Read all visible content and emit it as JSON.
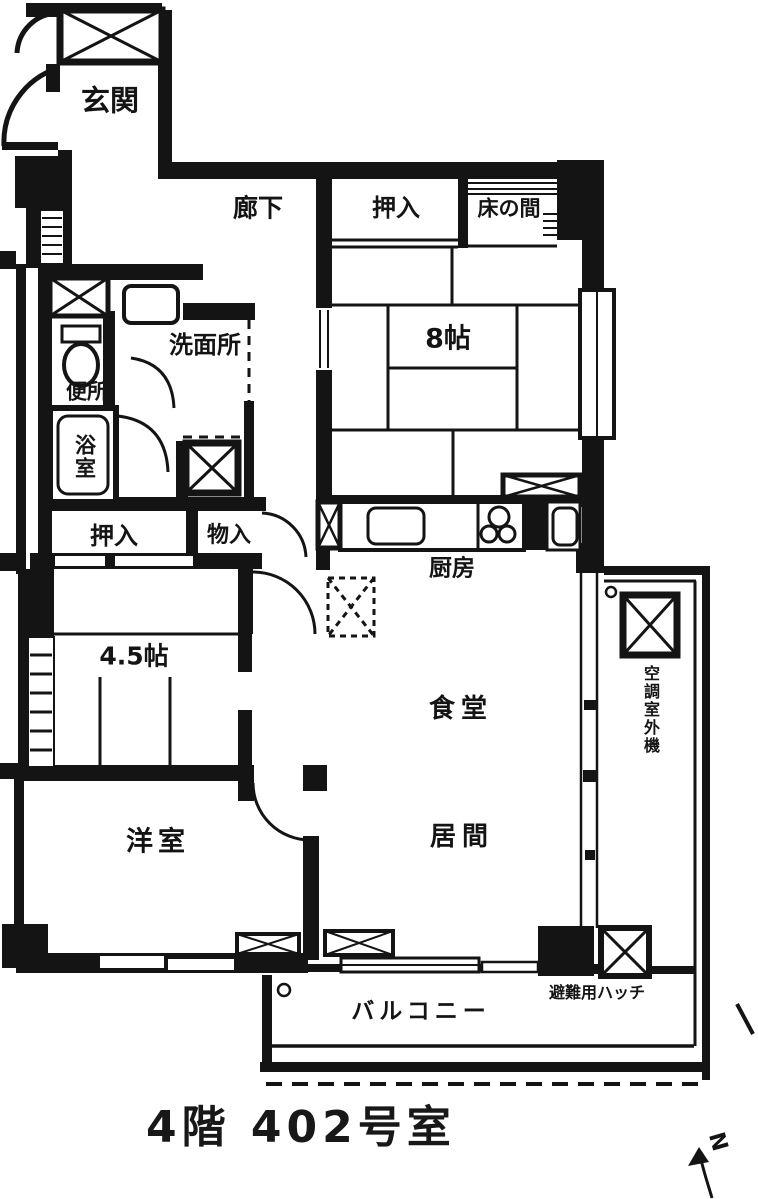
{
  "title": "4階 402号室",
  "plan": {
    "rooms": {
      "genkan": "玄関",
      "rouka": "廊下",
      "oshiire_upper": "押入",
      "tokonoma": "床の間",
      "washitsu8": "8帖",
      "senmenjo": "洗面所",
      "benjo": "便所",
      "yokushitsu": "浴室",
      "oshiire_lower": "押入",
      "monoire": "物入",
      "washitsu45": "4.5帖",
      "chubo": "厨房",
      "shokudo": "食堂",
      "ima": "居間",
      "yoshitsu": "洋室",
      "balcony": "バルコニー",
      "escape_hatch": "避難用ハッチ",
      "ac_outdoor_unit": "空調室外機"
    },
    "compass": {
      "north_label": "N"
    },
    "caption": "4階 402号室"
  },
  "colors": {
    "ink": "#141414",
    "paper": "#ffffff"
  }
}
